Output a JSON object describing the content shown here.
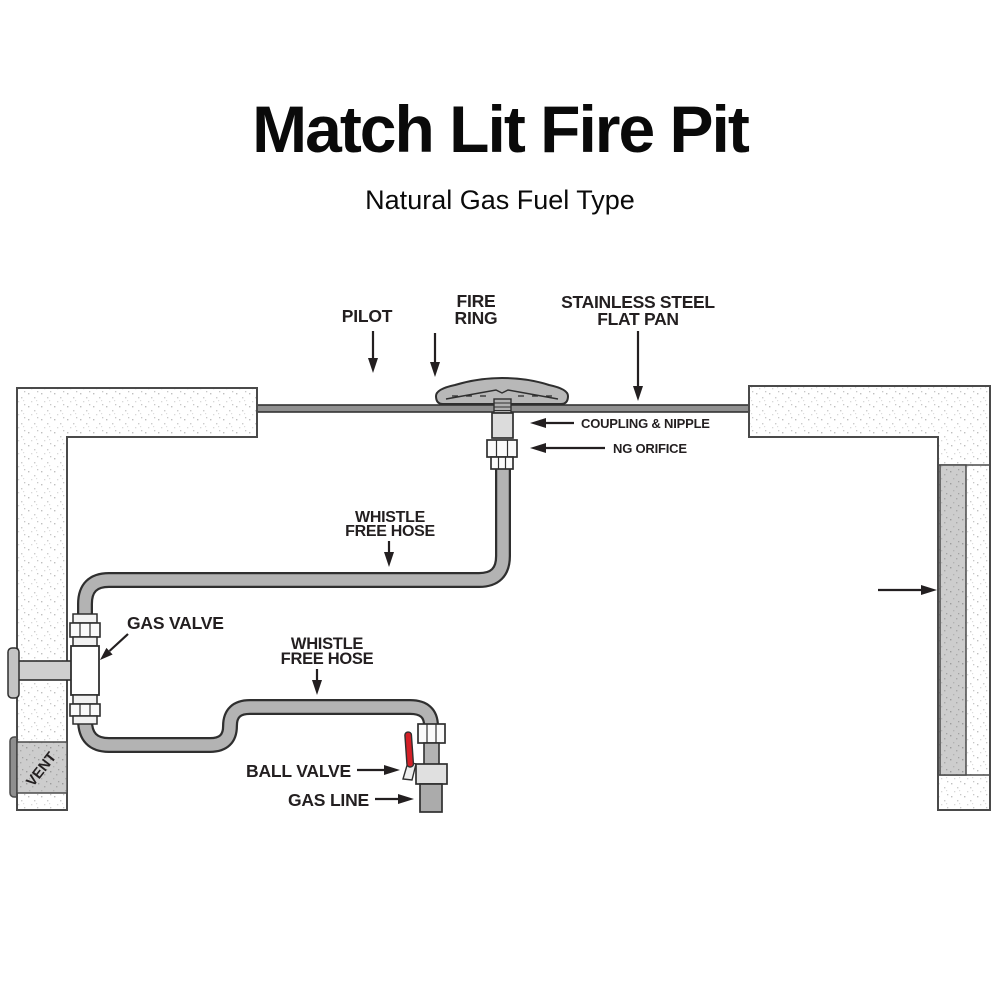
{
  "title": "Match Lit Fire Pit",
  "subtitle": "Natural Gas Fuel Type",
  "diagram": {
    "labels": {
      "pilot": "PILOT",
      "fire_ring": [
        "FIRE",
        "RING"
      ],
      "flat_pan": [
        "STAINLESS STEEL",
        "FLAT PAN"
      ],
      "coupling_nipple": "COUPLING & NIPPLE",
      "ng_orifice": "NG ORIFICE",
      "whistle_hose_upper": [
        "WHISTLE",
        "FREE HOSE"
      ],
      "gas_valve": "GAS VALVE",
      "whistle_hose_lower": [
        "WHISTLE",
        "FREE HOSE"
      ],
      "ball_valve": "BALL VALVE",
      "gas_line": "GAS LINE",
      "vent": "VENT"
    },
    "colors": {
      "label_text": "#231f20",
      "hose_fill": "#b3b3b3",
      "part_outline": "#2f2f2f",
      "wall_outline": "#4a4a4a",
      "vent_gray": "#cdcdcd",
      "pan_gray": "#909090",
      "ball_valve_handle_red": "#d42027"
    }
  }
}
